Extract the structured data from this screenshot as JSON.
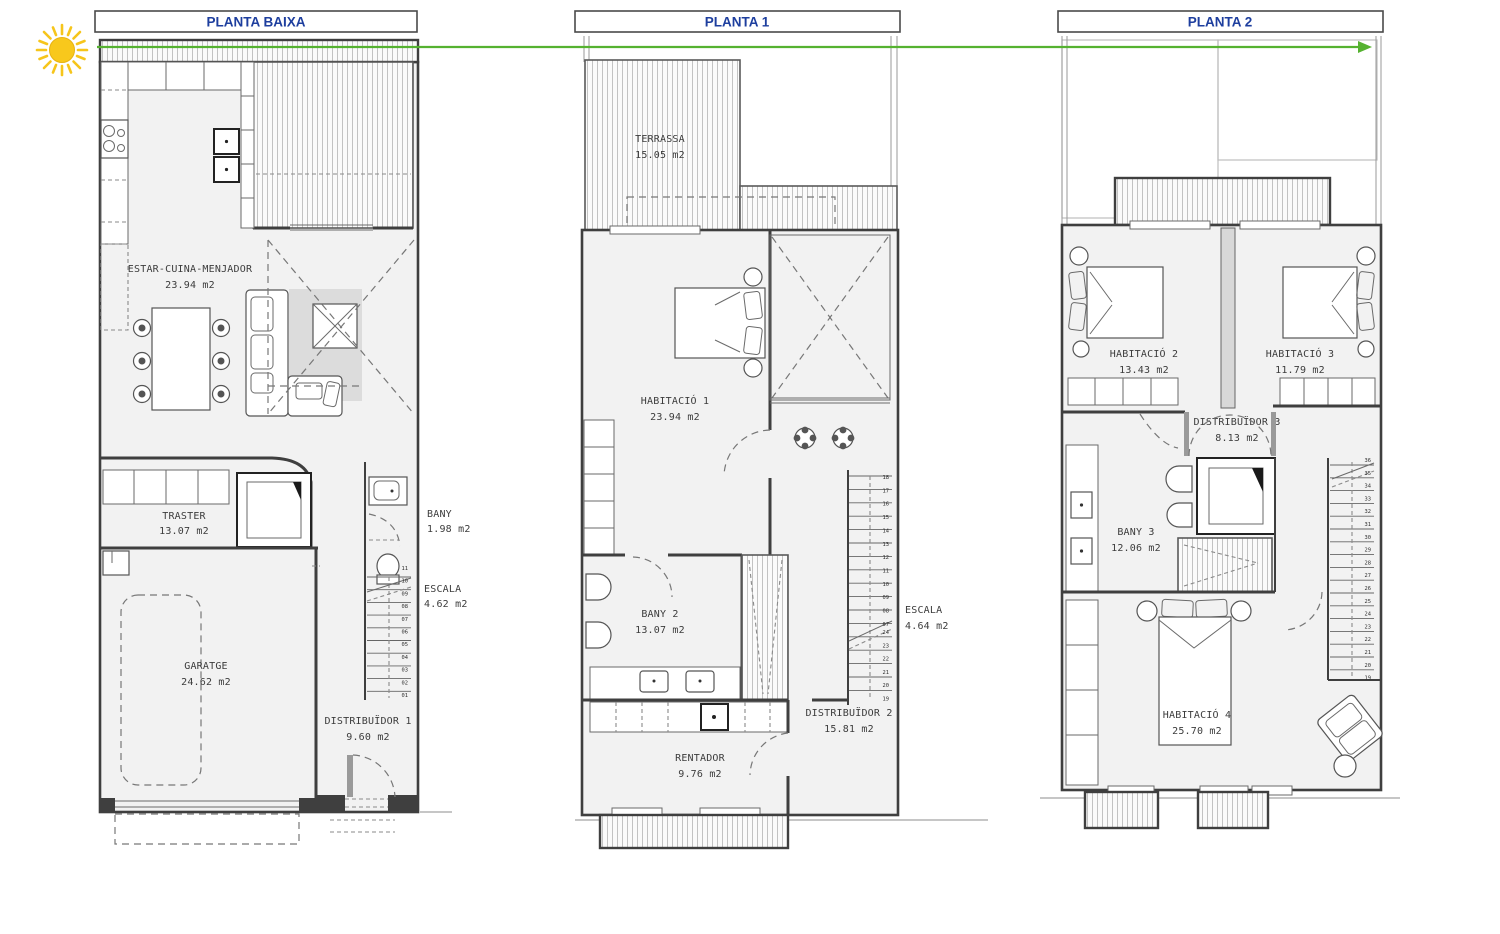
{
  "colors": {
    "title": "#1d3e9e",
    "arrow": "#55b230",
    "sun": "#f8c81c",
    "sun_edge": "#e8b312"
  },
  "plans": [
    {
      "title": "PLANTA BAIXA",
      "rooms": [
        {
          "name": "ESTAR-CUINA-MENJADOR",
          "area": "23.94 m2"
        },
        {
          "name": "TRASTER",
          "area": "13.07 m2"
        },
        {
          "name": "BANY",
          "area": "1.98 m2"
        },
        {
          "name": "ESCALA",
          "area": "4.62 m2"
        },
        {
          "name": "GARATGE",
          "area": "24.62 m2"
        },
        {
          "name": "DISTRIBUÏDOR 1",
          "area": "9.60 m2"
        }
      ],
      "stair_steps": [
        "11",
        "10",
        "09",
        "08",
        "07",
        "06",
        "05",
        "04",
        "03",
        "02",
        "01"
      ]
    },
    {
      "title": "PLANTA 1",
      "rooms": [
        {
          "name": "TERRASSA",
          "area": "15.05 m2"
        },
        {
          "name": "HABITACIÓ 1",
          "area": "23.94 m2"
        },
        {
          "name": "BANY 2",
          "area": "13.07 m2"
        },
        {
          "name": "ESCALA",
          "area": "4.64 m2"
        },
        {
          "name": "RENTADOR",
          "area": "9.76 m2"
        },
        {
          "name": "DISTRIBUÏDOR 2",
          "area": "15.81 m2"
        }
      ],
      "stair_steps_upper": [
        "18",
        "17",
        "16",
        "15",
        "14",
        "13",
        "12",
        "11",
        "10",
        "09",
        "08",
        "07"
      ],
      "stair_steps_lower": [
        "24",
        "23",
        "22",
        "21",
        "20",
        "19"
      ]
    },
    {
      "title": "PLANTA 2",
      "rooms": [
        {
          "name": "HABITACIÓ 2",
          "area": "13.43 m2"
        },
        {
          "name": "HABITACIÓ 3",
          "area": "11.79 m2"
        },
        {
          "name": "DISTRIBUÏDOR 3",
          "area": "8.13 m2"
        },
        {
          "name": "BANY 3",
          "area": "12.06 m2"
        },
        {
          "name": "HABITACIÓ 4",
          "area": "25.70 m2"
        }
      ],
      "stair_steps": [
        "36",
        "35",
        "34",
        "33",
        "32",
        "31",
        "30",
        "29",
        "28",
        "27",
        "26",
        "25",
        "24",
        "23",
        "22",
        "21",
        "20",
        "19"
      ]
    }
  ]
}
